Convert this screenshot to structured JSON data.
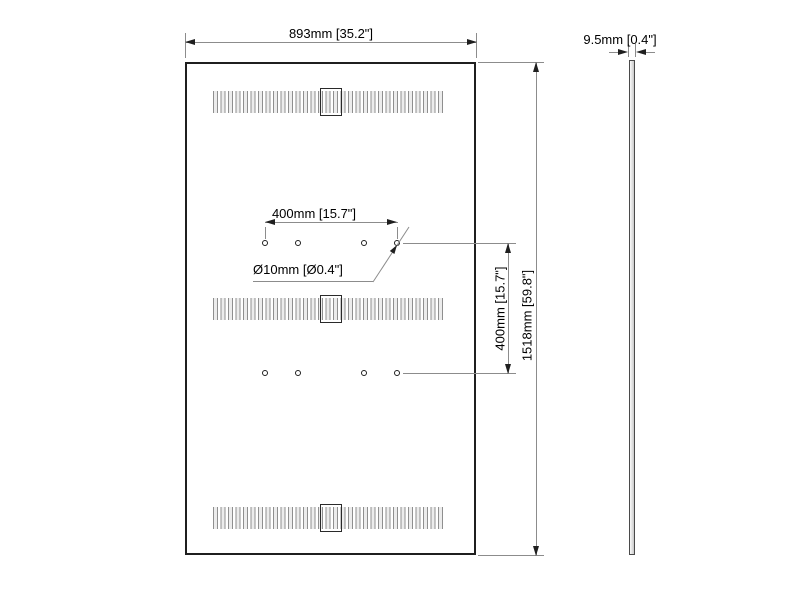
{
  "drawing": {
    "front_view": {
      "width_label": "893mm [35.2\"]",
      "height_label": "1518mm [59.8\"]",
      "vesa_width_label": "400mm [15.7\"]",
      "vesa_height_label": "400mm [15.7\"]",
      "hole_diameter_label": "Ø10mm [Ø0.4\"]"
    },
    "side_view": {
      "thickness_label": "9.5mm [0.4\"]"
    }
  }
}
